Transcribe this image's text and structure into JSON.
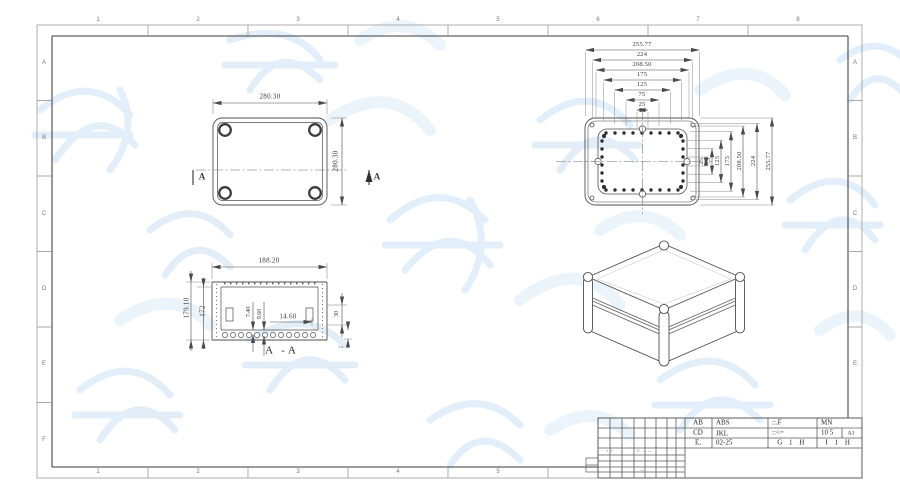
{
  "sheet": {
    "zone_cols": [
      "1",
      "2",
      "3",
      "4",
      "5",
      "6",
      "7",
      "8"
    ],
    "zone_rows": [
      "A",
      "B",
      "C",
      "D",
      "E",
      "F"
    ]
  },
  "views": {
    "plan": {
      "width": "280.30",
      "height": "280.30",
      "section_mark": "A"
    },
    "section": {
      "title": "A -A",
      "width": "188.20",
      "outer_height": "179.10",
      "inner_height": "172",
      "boss_depth_1": "7.40",
      "boss_depth_2": "9.60",
      "step_width": "14.60",
      "flange_height": "30",
      "base_thickness": "2"
    },
    "lid": {
      "dims_top": [
        "255.77",
        "224",
        "208.50",
        "175",
        "125",
        "75",
        "25"
      ],
      "dims_right": [
        "25",
        "75",
        "125",
        "175",
        "208.50",
        "224",
        "255.77"
      ]
    }
  },
  "title_block": {
    "row1": {
      "code": "AB",
      "material": "ABS",
      "f1": "::.F",
      "f2": "MN"
    },
    "row2": {
      "code": "CD",
      "material": "JKL",
      "f1": "::<=",
      "f2": "10 5",
      "sheet": "A3"
    },
    "row3": {
      "code": "E,",
      "material": "02-25",
      "f1": "G 1 H",
      "f2": "I 1 H"
    },
    "marks": {
      "m1": "· ▪ ▪ ·",
      "m2": "C ——",
      "m3": "· ·",
      "m4": "— ·"
    }
  }
}
